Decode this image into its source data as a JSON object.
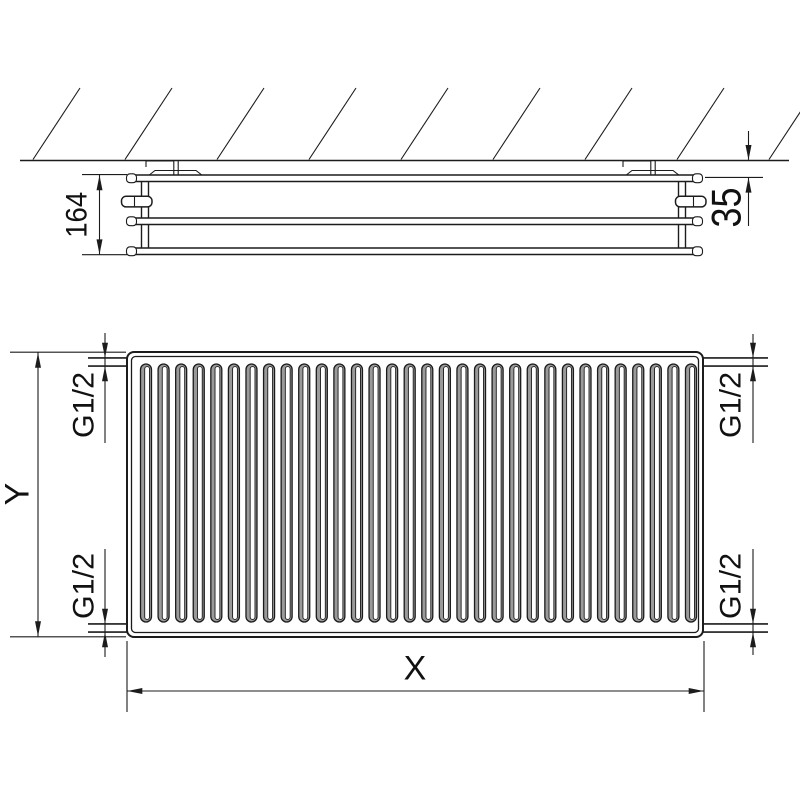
{
  "drawing": {
    "top_view": {
      "depth_label": "164",
      "wall_gap_label": "35"
    },
    "front_view": {
      "height_label": "Y",
      "width_label": "X",
      "fin_count": 32,
      "connection_labels": {
        "top_left": "G1/2",
        "bottom_left": "G1/2",
        "top_right": "G1/2",
        "bottom_right": "G1/2"
      }
    },
    "colors": {
      "line": "#1c1c1c",
      "fin_shade": "#9a9a9a",
      "background": "#ffffff"
    }
  }
}
